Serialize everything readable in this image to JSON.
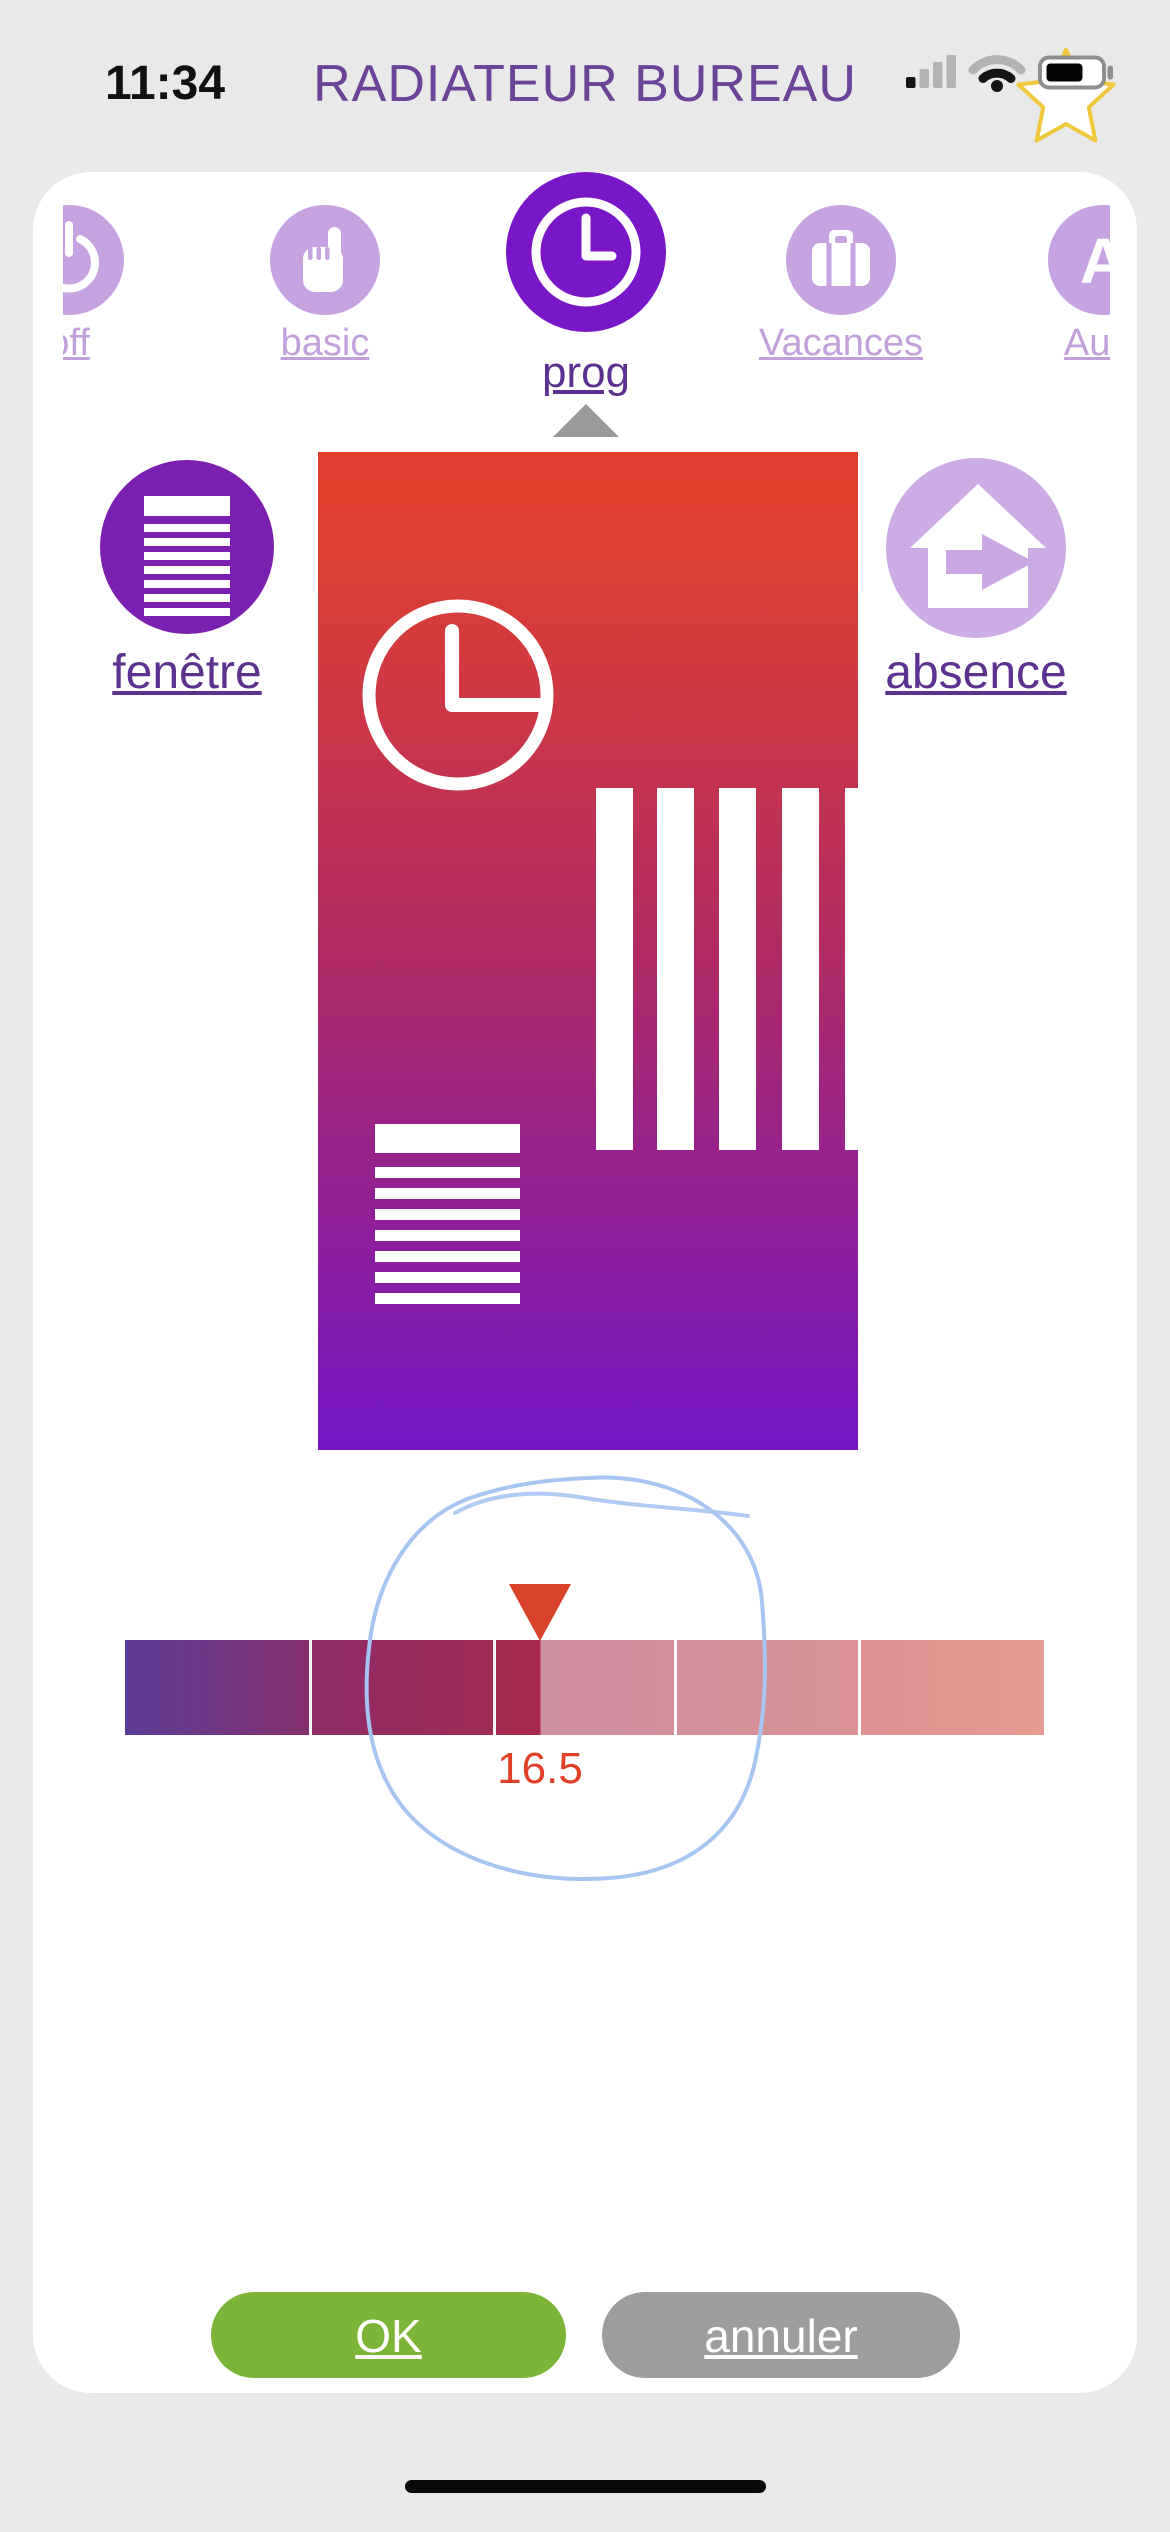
{
  "status_bar": {
    "time": "11:34"
  },
  "header": {
    "title": "RADIATEUR BUREAU"
  },
  "mode_tabs": {
    "items": [
      {
        "label": "off",
        "icon": "power-icon",
        "selected": false
      },
      {
        "label": "basic",
        "icon": "hand-icon",
        "selected": false
      },
      {
        "label": "prog",
        "icon": "clock-icon",
        "selected": true
      },
      {
        "label": "Vacances",
        "icon": "suitcase-icon",
        "selected": false
      },
      {
        "label": "Auto",
        "icon": "letter-a-icon",
        "selected": false
      }
    ]
  },
  "side_modes": {
    "fenetre": {
      "label": "fenêtre",
      "active": true,
      "icon": "radiator-icon"
    },
    "absence": {
      "label": "absence",
      "active": false,
      "icon": "house-exit-icon"
    }
  },
  "preview": {
    "icons": [
      "clock-icon",
      "schedule-bars-icon",
      "radiator-icon"
    ]
  },
  "temperature_slider": {
    "value": "16.5",
    "segment_count": 5,
    "annotation": "hand-drawn-circle-highlight"
  },
  "actions": {
    "ok_label": "OK",
    "cancel_label": "annuler"
  },
  "colors": {
    "title_purple": "#6B4397",
    "selected_purple": "#7916C8",
    "inactive_purple": "#C7A3E2",
    "dark_label_purple": "#5C3190",
    "ok_green": "#7CB437",
    "cancel_gray": "#9D9D9D",
    "marker_red": "#D8422B",
    "value_red": "#E23F28",
    "sketch_blue": "#A6C5F2",
    "gradient_top": "#E53B2E",
    "gradient_bottom": "#7315C5"
  }
}
